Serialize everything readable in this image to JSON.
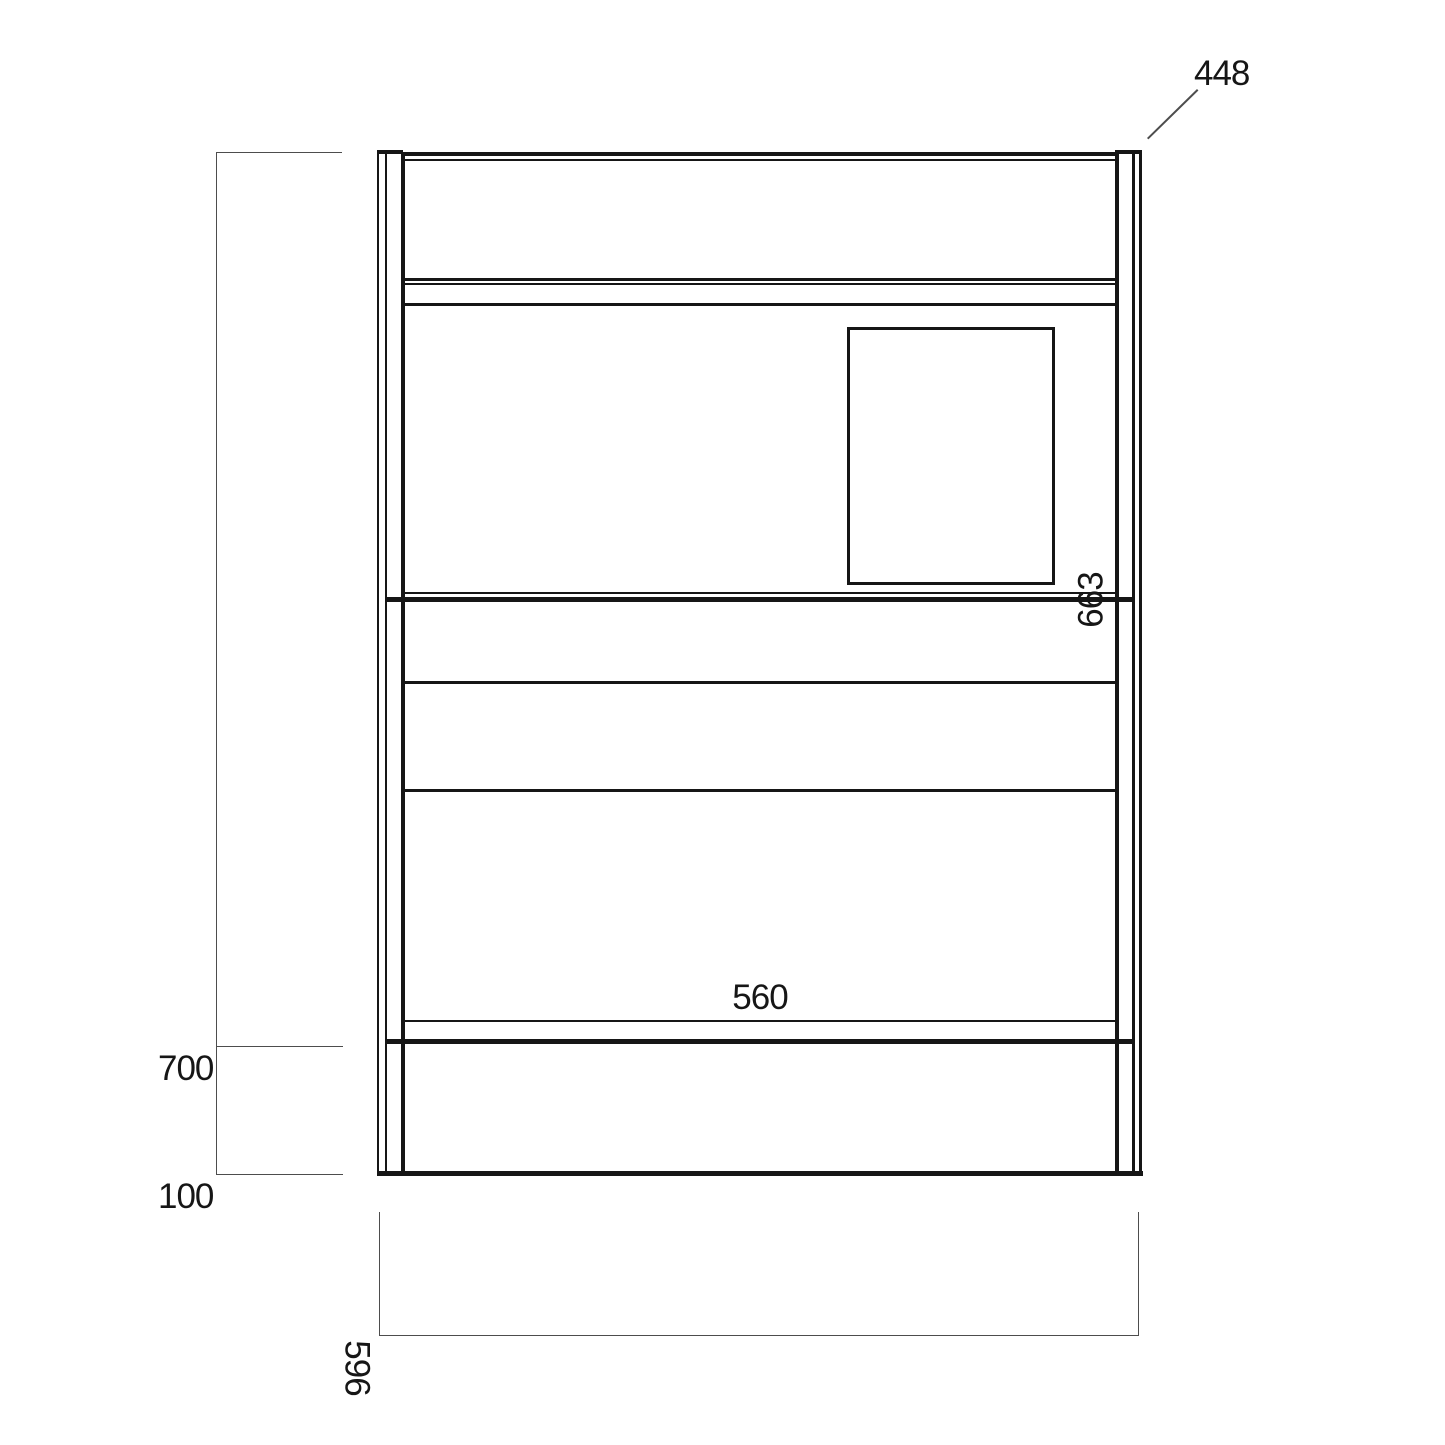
{
  "diagram": {
    "type": "technical-drawing-front-elevation",
    "dimension_labels": {
      "top_right_leader": "448",
      "left_upper": "700",
      "left_lower": "100",
      "bottom_center": "560",
      "right_side_rotated": "663",
      "bottom_left_rotated": "596"
    },
    "colors": {
      "line": "#161616",
      "dimension_line": "#4d4d4d",
      "background": "#ffffff",
      "text": "#161616"
    }
  }
}
